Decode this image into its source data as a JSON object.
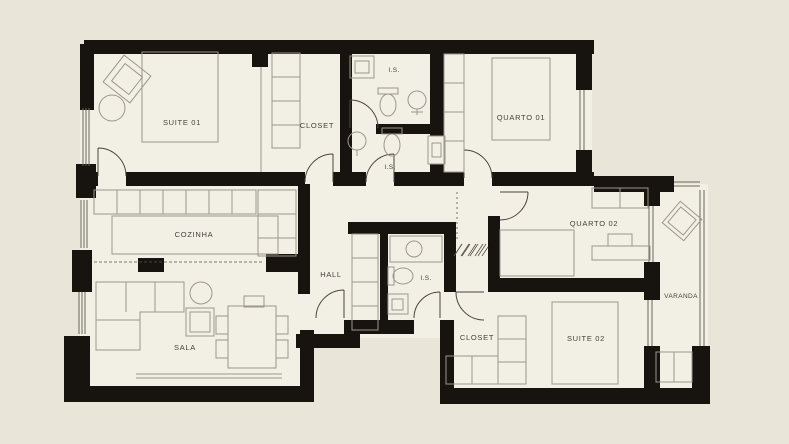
{
  "plan": {
    "type": "apartment-floor-plan",
    "rooms": [
      {
        "id": "suite-01",
        "label": "SUITE 01"
      },
      {
        "id": "closet-01",
        "label": "CLOSET"
      },
      {
        "id": "is-top",
        "label": "I.S."
      },
      {
        "id": "is-mid",
        "label": "I.S."
      },
      {
        "id": "quarto-01",
        "label": "QUARTO 01"
      },
      {
        "id": "cozinha",
        "label": "COZINHA"
      },
      {
        "id": "hall",
        "label": "HALL"
      },
      {
        "id": "is-hall",
        "label": "I.S."
      },
      {
        "id": "sala",
        "label": "SALA"
      },
      {
        "id": "quarto-02",
        "label": "QUARTO 02"
      },
      {
        "id": "closet-02",
        "label": "CLOSET"
      },
      {
        "id": "suite-02",
        "label": "SUITE 02"
      },
      {
        "id": "varanda",
        "label": "VARANDA"
      }
    ],
    "colors": {
      "background": "#e9e5d8",
      "floor": "#f2efe5",
      "wall": "#17130e",
      "furniture_line": "#9b978b",
      "text": "#45423c"
    }
  }
}
